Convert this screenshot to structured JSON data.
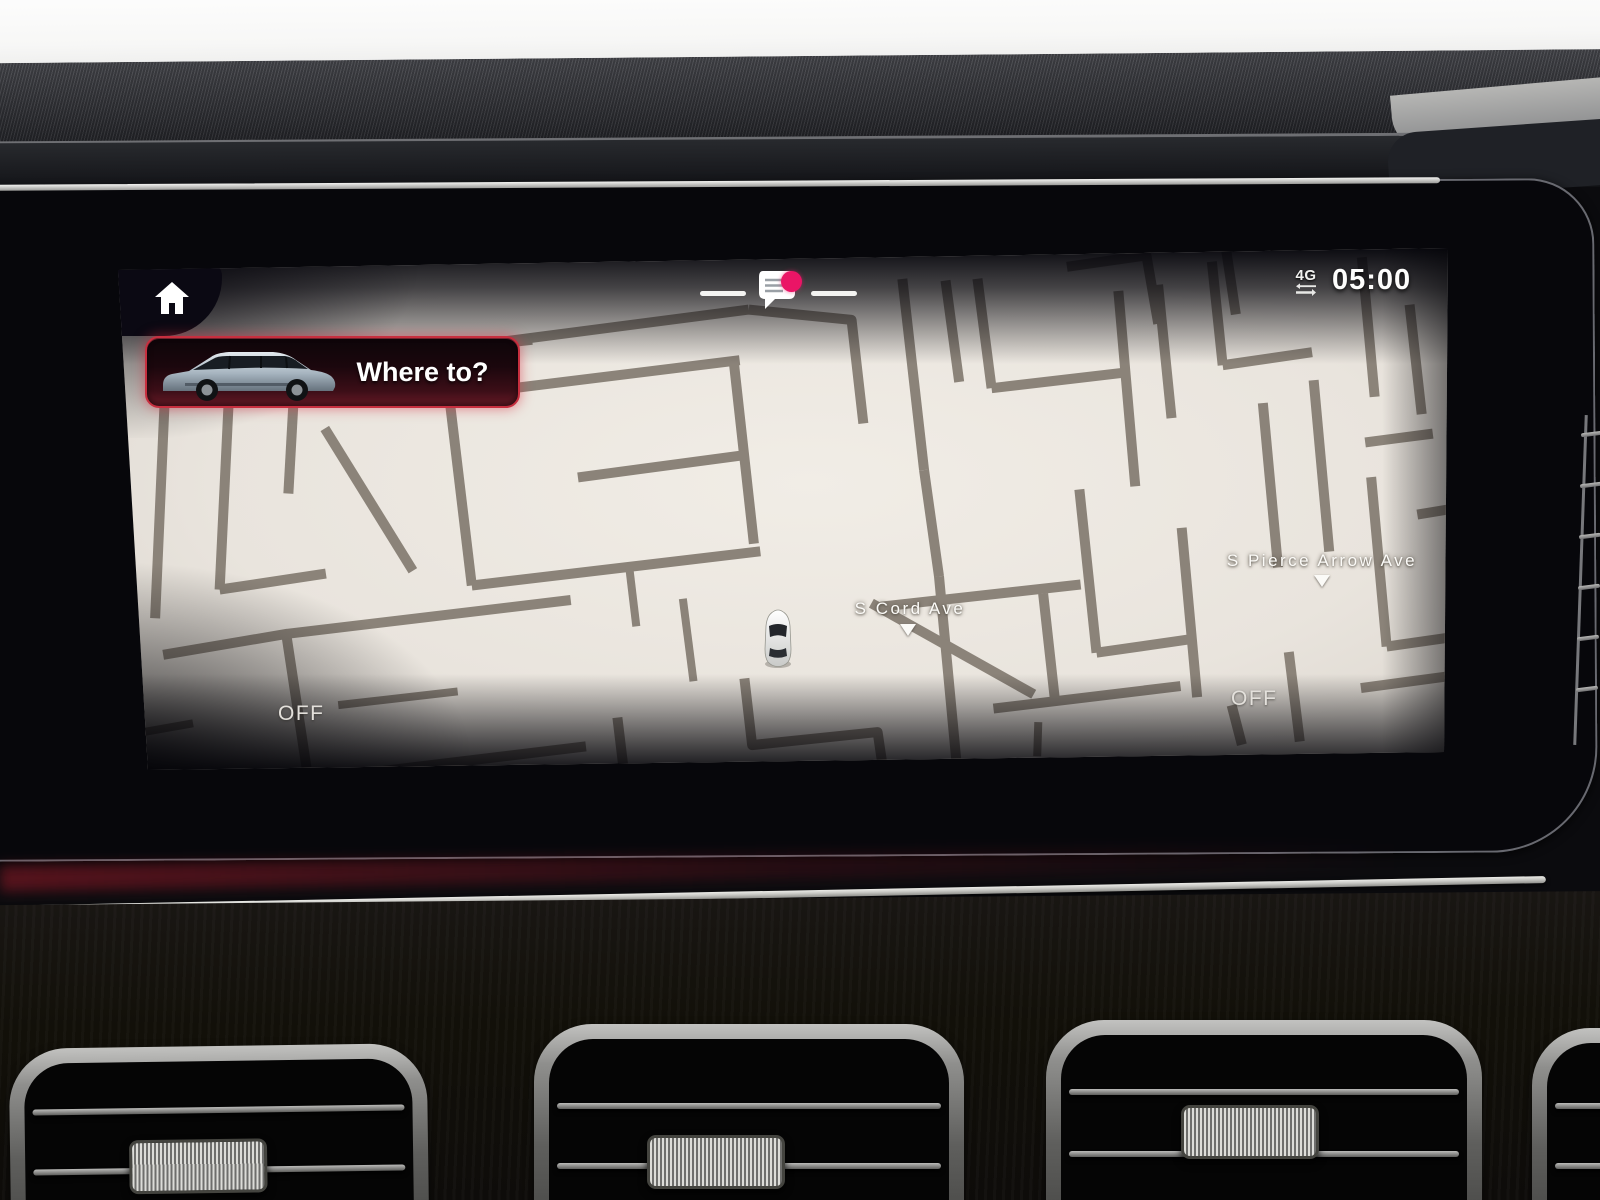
{
  "status_bar": {
    "network": "4G",
    "time": "05:00"
  },
  "navigation": {
    "where_to_label": "Where to?"
  },
  "map": {
    "street_labels": [
      "S Cord Ave",
      "S Pierce Arrow Ave"
    ],
    "climate_left": "OFF",
    "climate_right": "OFF"
  },
  "icons": {
    "home": "home-icon",
    "notifications": "chat-bubble-icon",
    "notification_badge": "badge-dot",
    "network_arrows": "data-transfer-arrows-icon",
    "vehicle_marker": "car-top-view-icon",
    "vehicle_image": "suv-side-view-image"
  },
  "colors": {
    "map_background": "#e9e4dd",
    "road": "#8b8379",
    "card_border_red": "#c72f3f",
    "notification_badge_pink": "#ea1566"
  }
}
